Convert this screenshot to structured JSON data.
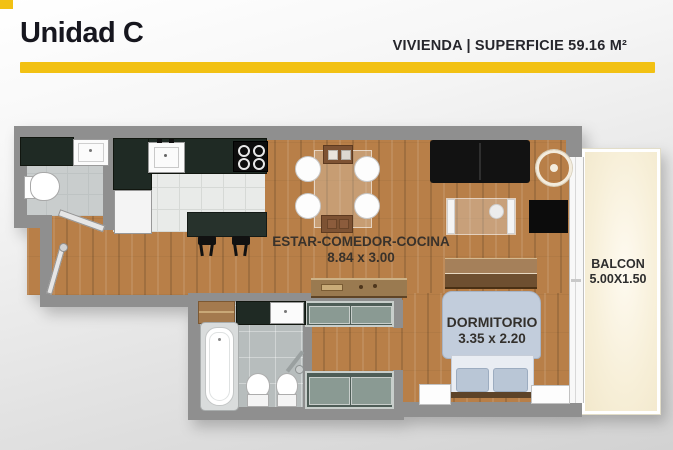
{
  "header": {
    "title": "Unidad C",
    "subtitle": "VIVIENDA |  SUPERFICIE 59.16 M²",
    "accent_color": "#F2C113"
  },
  "floorplan": {
    "rooms": {
      "living": {
        "name": "ESTAR-COMEDOR-COCINA",
        "size": "8.84 x 3.00"
      },
      "bedroom": {
        "name": "DORMITORIO",
        "size": "3.35 x 2.20"
      },
      "balcony": {
        "name": "BALCON",
        "size": "5.00X1.50"
      }
    }
  }
}
